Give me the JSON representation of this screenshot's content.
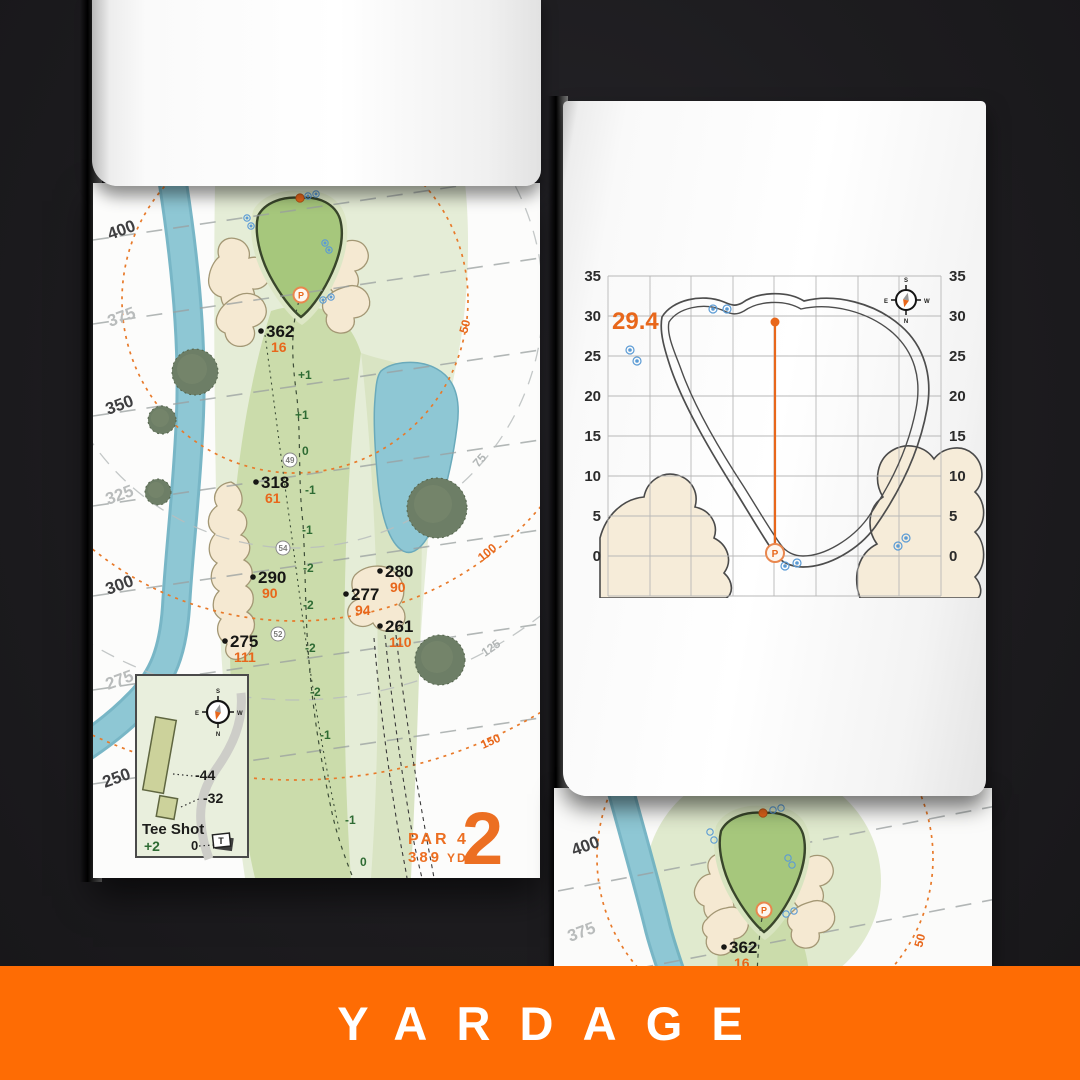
{
  "banner": {
    "label": "YARDAGE"
  },
  "colors": {
    "banner_orange": "#fe6c04",
    "accent_orange": "#e8671b",
    "fairway_green": "#cbdcab",
    "putting_green": "#a6c77c",
    "water_blue": "#8ec7d4",
    "bunker_sand": "#f5e9d2"
  },
  "hole_page": {
    "hole_number": "2",
    "par_label": "PAR 4",
    "distance_number": "389",
    "distance_unit": "YD",
    "side_yardages": [
      "400",
      "375",
      "350",
      "325",
      "300",
      "275",
      "250"
    ],
    "arc_labels": [
      "50",
      "75",
      "100",
      "125",
      "150"
    ],
    "points": [
      {
        "yards": "362",
        "to_pin": "16"
      },
      {
        "yards": "318",
        "to_pin": "61"
      },
      {
        "yards": "290",
        "to_pin": "90"
      },
      {
        "yards": "280",
        "to_pin": "90"
      },
      {
        "yards": "277",
        "to_pin": "94"
      },
      {
        "yards": "261",
        "to_pin": "110"
      },
      {
        "yards": "275",
        "to_pin": "111"
      }
    ],
    "elevation_marks": [
      "+1",
      "+1",
      "0",
      "-1",
      "-1",
      "-2",
      "-2",
      "-2",
      "-2",
      "-1",
      "-1",
      "0"
    ],
    "circled_marks": [
      "49",
      "54",
      "52"
    ],
    "pin_marker": "P",
    "tee_inset": {
      "title": "Tee Shot",
      "strokes": "+2",
      "offset_long": "-44",
      "offset_short": "-32",
      "zero": "0",
      "tee_icon": "T"
    },
    "compass": {
      "n": "N",
      "s": "S",
      "e": "E",
      "w": "W"
    }
  },
  "green_page": {
    "depth_value": "29.4",
    "tick_labels": [
      "35",
      "30",
      "25",
      "20",
      "15",
      "10",
      "5",
      "0"
    ],
    "pin_marker": "P",
    "compass": {
      "n": "N",
      "s": "S",
      "e": "E",
      "w": "W"
    }
  },
  "next_page": {
    "side_yardages": [
      "400",
      "375"
    ],
    "arc_label": "50",
    "point": {
      "yards": "362",
      "to_pin": "16"
    },
    "pin_marker": "P"
  }
}
